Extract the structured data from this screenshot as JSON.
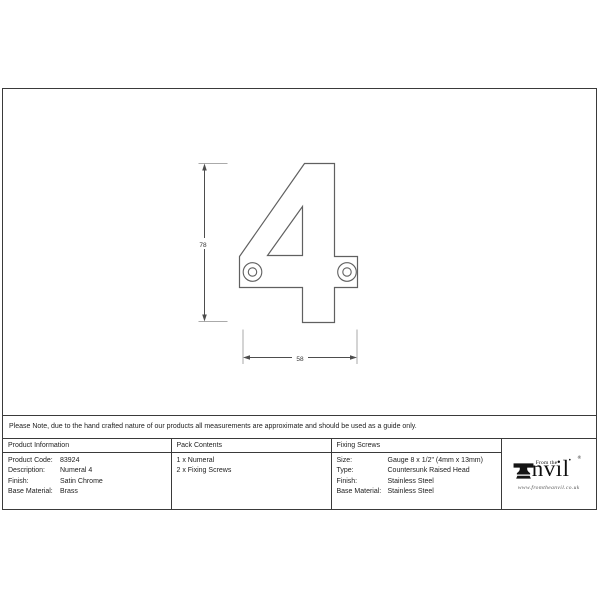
{
  "note": "Please Note, due to the hand crafted nature of our products all measurements are approximate and should be used as a guide only.",
  "drawing": {
    "numeral": "4",
    "height_dim": "78",
    "width_dim": "58"
  },
  "table": {
    "product_information": {
      "header": "Product Information",
      "rows": [
        {
          "label": "Product Code:",
          "value": "83924"
        },
        {
          "label": "Description:",
          "value": "Numeral 4"
        },
        {
          "label": "Finish:",
          "value": "Satin Chrome"
        },
        {
          "label": "Base Material:",
          "value": "Brass"
        }
      ]
    },
    "pack_contents": {
      "header": "Pack Contents",
      "items": [
        "1 x Numeral",
        "2 x Fixing Screws"
      ]
    },
    "fixing_screws": {
      "header": "Fixing Screws",
      "rows": [
        {
          "label": "Size:",
          "value": "Gauge 8 x 1/2\" (4mm x 13mm)"
        },
        {
          "label": "Type:",
          "value": "Countersunk Raised Head"
        },
        {
          "label": "Finish:",
          "value": "Stainless Steel"
        },
        {
          "label": "Base Material:",
          "value": "Stainless Steel"
        }
      ]
    }
  },
  "logo": {
    "prefix": "From the",
    "dot": "•",
    "registered": "®",
    "brand": "nvil",
    "url": "www.fromtheanvil.co.uk"
  },
  "colors": {
    "border": "#3a3a3a",
    "drawing_line": "#606060",
    "background": "#ffffff"
  }
}
